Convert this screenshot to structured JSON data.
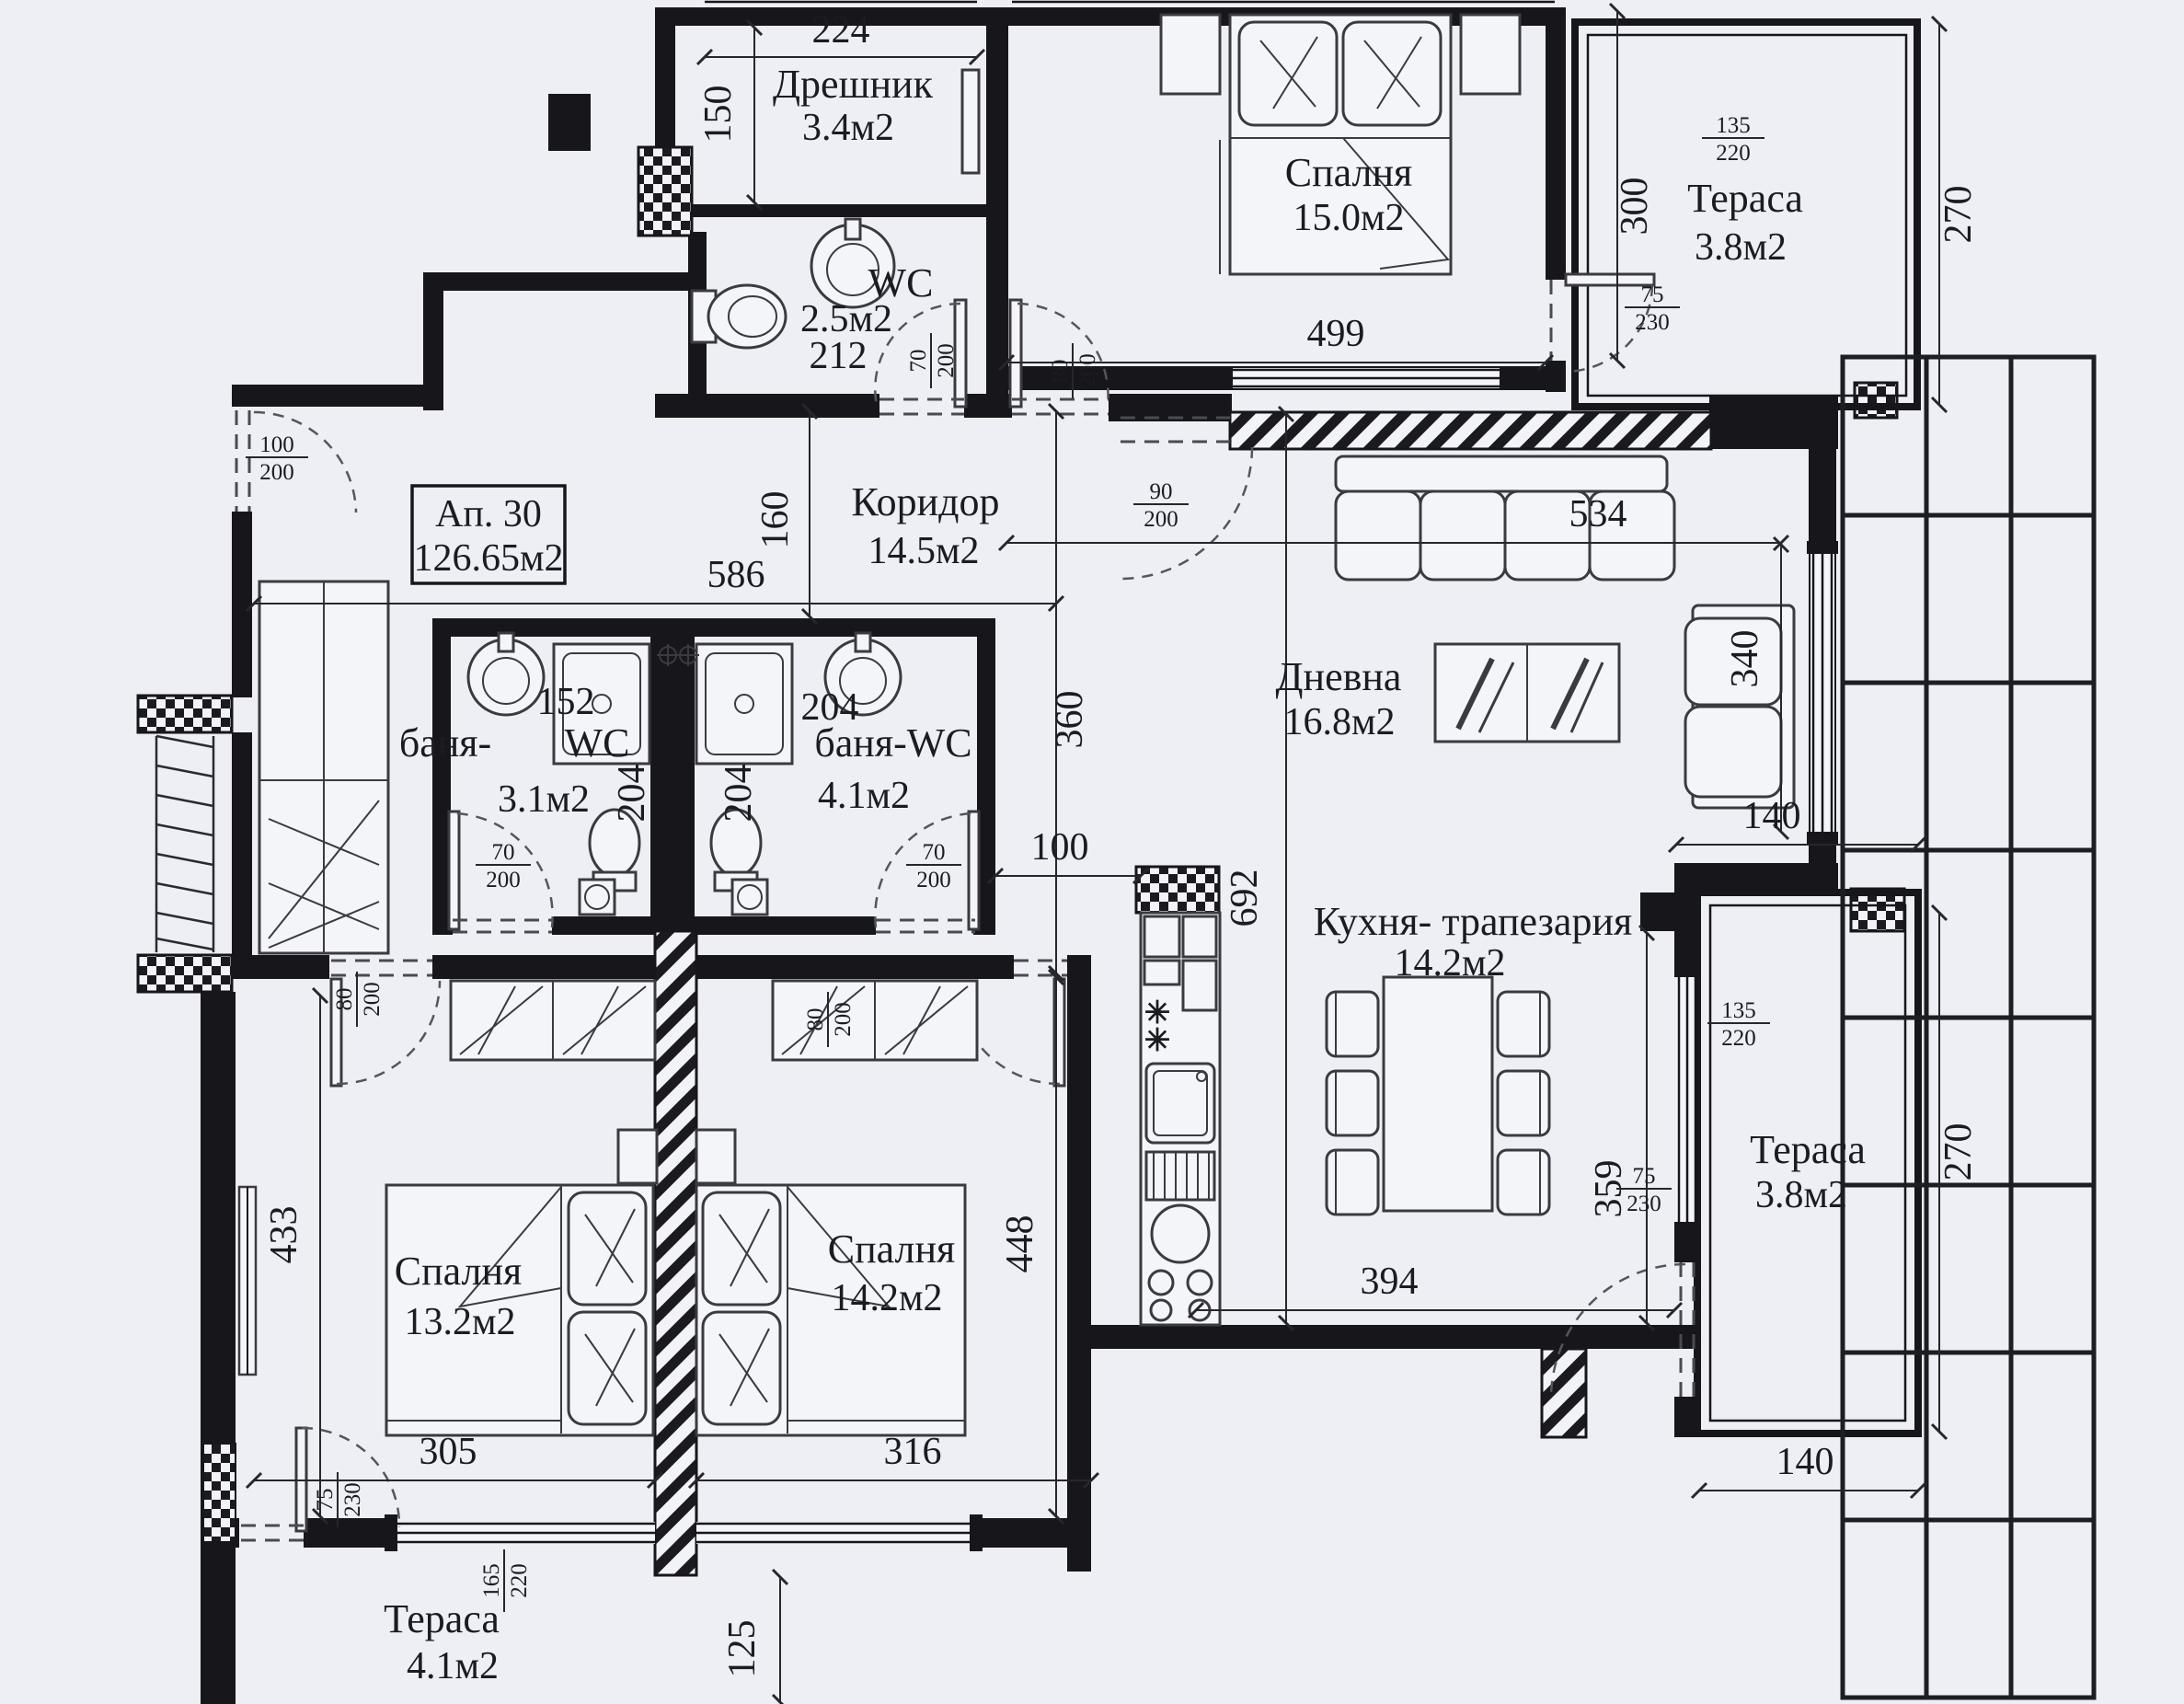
{
  "title": {
    "apartment": "Ап. 30",
    "total_area": "126.65м2"
  },
  "rooms": {
    "closet": {
      "name": "Дрешник",
      "area": "3.4м2"
    },
    "wc": {
      "name": "WC",
      "area": "2.5м2",
      "width": "212"
    },
    "bedroom_top": {
      "name": "Спалня",
      "area": "15.0м2"
    },
    "terrace_top": {
      "name": "Тераса",
      "area": "3.8м2"
    },
    "corridor": {
      "name": "Коридор",
      "area": "14.5м2"
    },
    "bath_left": {
      "name_a": "баня-",
      "name_b": "WC",
      "area": "3.1м2"
    },
    "bath_right": {
      "name": "баня-WC",
      "area": "4.1м2"
    },
    "living": {
      "name": "Дневна",
      "area": "16.8м2"
    },
    "kitchen": {
      "name": "Кухня- трапезария",
      "area": "14.2м2"
    },
    "bedroom_left": {
      "name": "Спалня",
      "area": "13.2м2"
    },
    "bedroom_mid": {
      "name": "Спалня",
      "area": "14.2м2"
    },
    "terrace_right": {
      "name": "Тераса",
      "area": "3.8м2"
    },
    "terrace_bottom": {
      "name": "Тераса",
      "area": "4.1м2"
    }
  },
  "dims": {
    "closet_w": "224",
    "closet_h": "150",
    "bedroom_top_w": "499",
    "bedroom_top_h": "300",
    "terrace_top_h": "270",
    "corridor_w": "586",
    "corridor_h": "160",
    "hall_h": "360",
    "hall_w": "100",
    "living_w": "534",
    "living_window": "340",
    "kitchen_col_h": "692",
    "bath_left_a": "152",
    "bath_left_b": "204",
    "bath_right_a": "204",
    "bath_right_b": "204",
    "bedroom_left_h": "433",
    "bedroom_mid_h": "448",
    "kitchen_right_h": "359",
    "kitchen_w": "394",
    "terrace_right_top_w": "140",
    "terrace_right_h": "270",
    "terrace_right_bottom_w": "140",
    "bedroom_left_w": "305",
    "bedroom_mid_w": "316",
    "terrace_bottom_h": "125"
  },
  "openings": {
    "entry_door": {
      "num": "100",
      "den": "200"
    },
    "wc_door": {
      "num": "70",
      "den": "200"
    },
    "bedroom_top_door": {
      "num": "80",
      "den": "200"
    },
    "living_door": {
      "num": "90",
      "den": "200"
    },
    "terrace_top_door": {
      "num": "75",
      "den": "230"
    },
    "bath_left_door": {
      "num": "70",
      "den": "200"
    },
    "bath_right_door": {
      "num": "70",
      "den": "200"
    },
    "bedroom_left_door": {
      "num": "80",
      "den": "200"
    },
    "bedroom_mid_door": {
      "num": "80",
      "den": "200"
    },
    "kitchen_terrace_door": {
      "num": "75",
      "den": "230"
    },
    "bedroom_left_terrace_door": {
      "num": "75",
      "den": "230"
    },
    "window_top_terrace": {
      "num": "135",
      "den": "220"
    },
    "window_right_terrace": {
      "num": "135",
      "den": "220"
    },
    "window_bottom_terrace": {
      "num": "165",
      "den": "220"
    }
  },
  "fixtures": {
    "hob_mark": "✳"
  },
  "colors": {
    "background": "#edeff4",
    "ink": "#16161b"
  }
}
